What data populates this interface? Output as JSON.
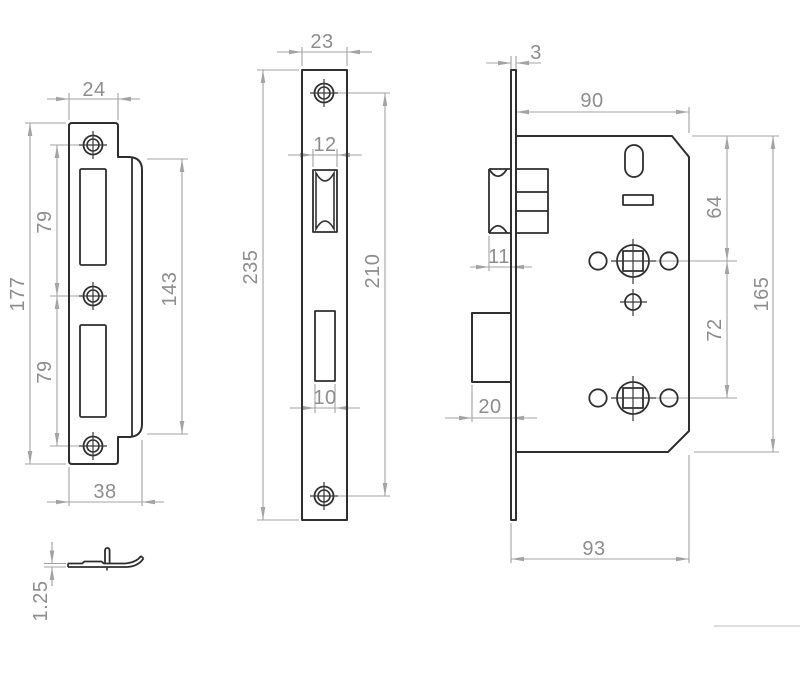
{
  "palette": {
    "background": "#ffffff",
    "outline_color": "#2f2f2f",
    "dimension_line_color": "#a3a3a3",
    "dimension_text_color": "#8d8d8d"
  },
  "views": {
    "strike_plate_front": {
      "dims": {
        "top_width": "24",
        "overall_height": "177",
        "hole_spacing_upper": "79",
        "hole_spacing_lower": "79",
        "lip_height": "143",
        "overall_width": "38"
      }
    },
    "strike_plate_profile": {
      "dims": {
        "thickness": "1.25"
      }
    },
    "faceplate_front": {
      "dims": {
        "width": "23",
        "latch_opening_width": "12",
        "overall_height": "235",
        "screw_hole_spacing": "210",
        "deadbolt_opening_width": "10"
      }
    },
    "lock_body_side": {
      "dims": {
        "faceplate_thickness": "3",
        "body_width": "90",
        "top_to_spindle": "64",
        "latch_projection": "11",
        "spindle_spacing": "72",
        "body_height": "165",
        "deadbolt_projection": "20",
        "overall_depth": "93"
      }
    }
  }
}
